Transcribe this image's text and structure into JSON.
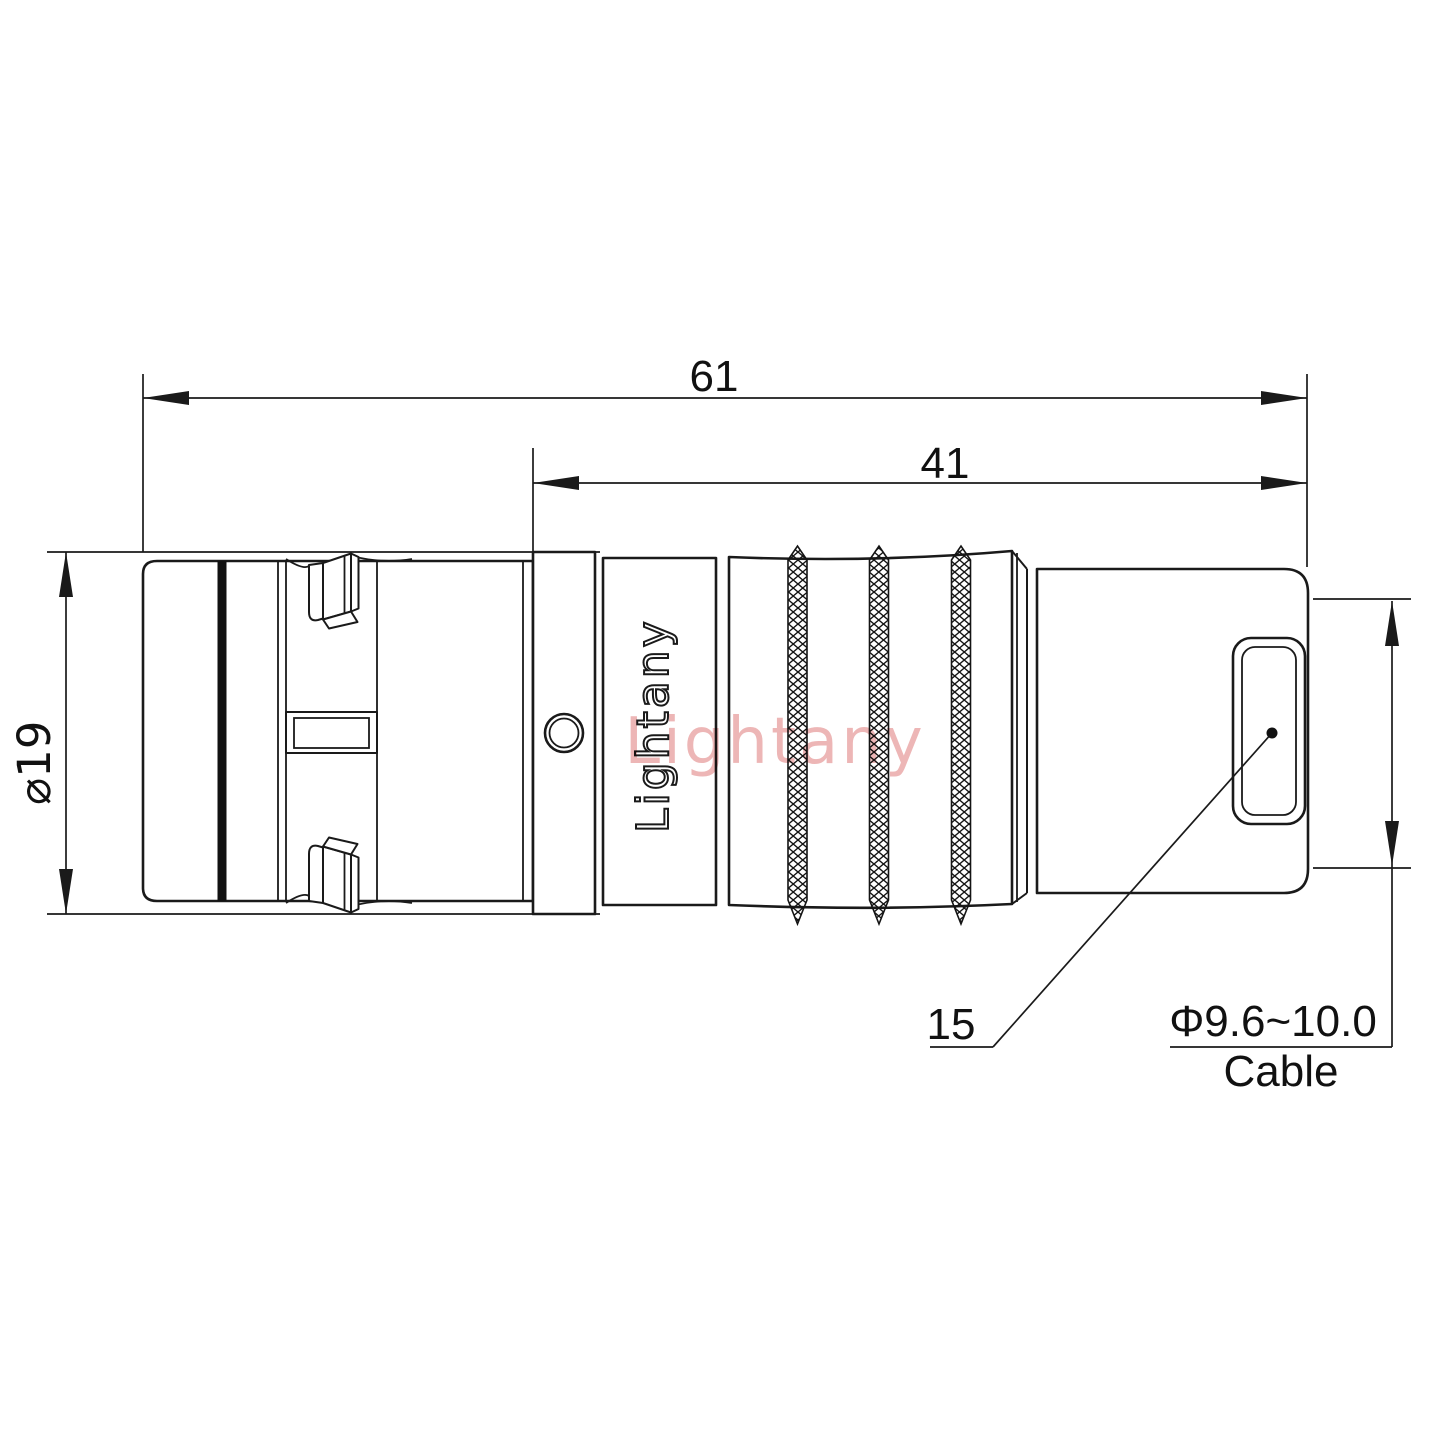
{
  "drawing": {
    "background": "#ffffff",
    "line_color": "#1a1a1a",
    "watermark": {
      "text": "Lightany",
      "color": "#edb6b6"
    },
    "engraving": {
      "text": "Lightany"
    },
    "dimensions": {
      "overall_length": "61",
      "rear_section_length": "41",
      "shell_diameter": "⌀19",
      "leader_ref": "15",
      "cable_diameter_range": "Φ9.6~10.0",
      "cable_label": "Cable"
    }
  }
}
